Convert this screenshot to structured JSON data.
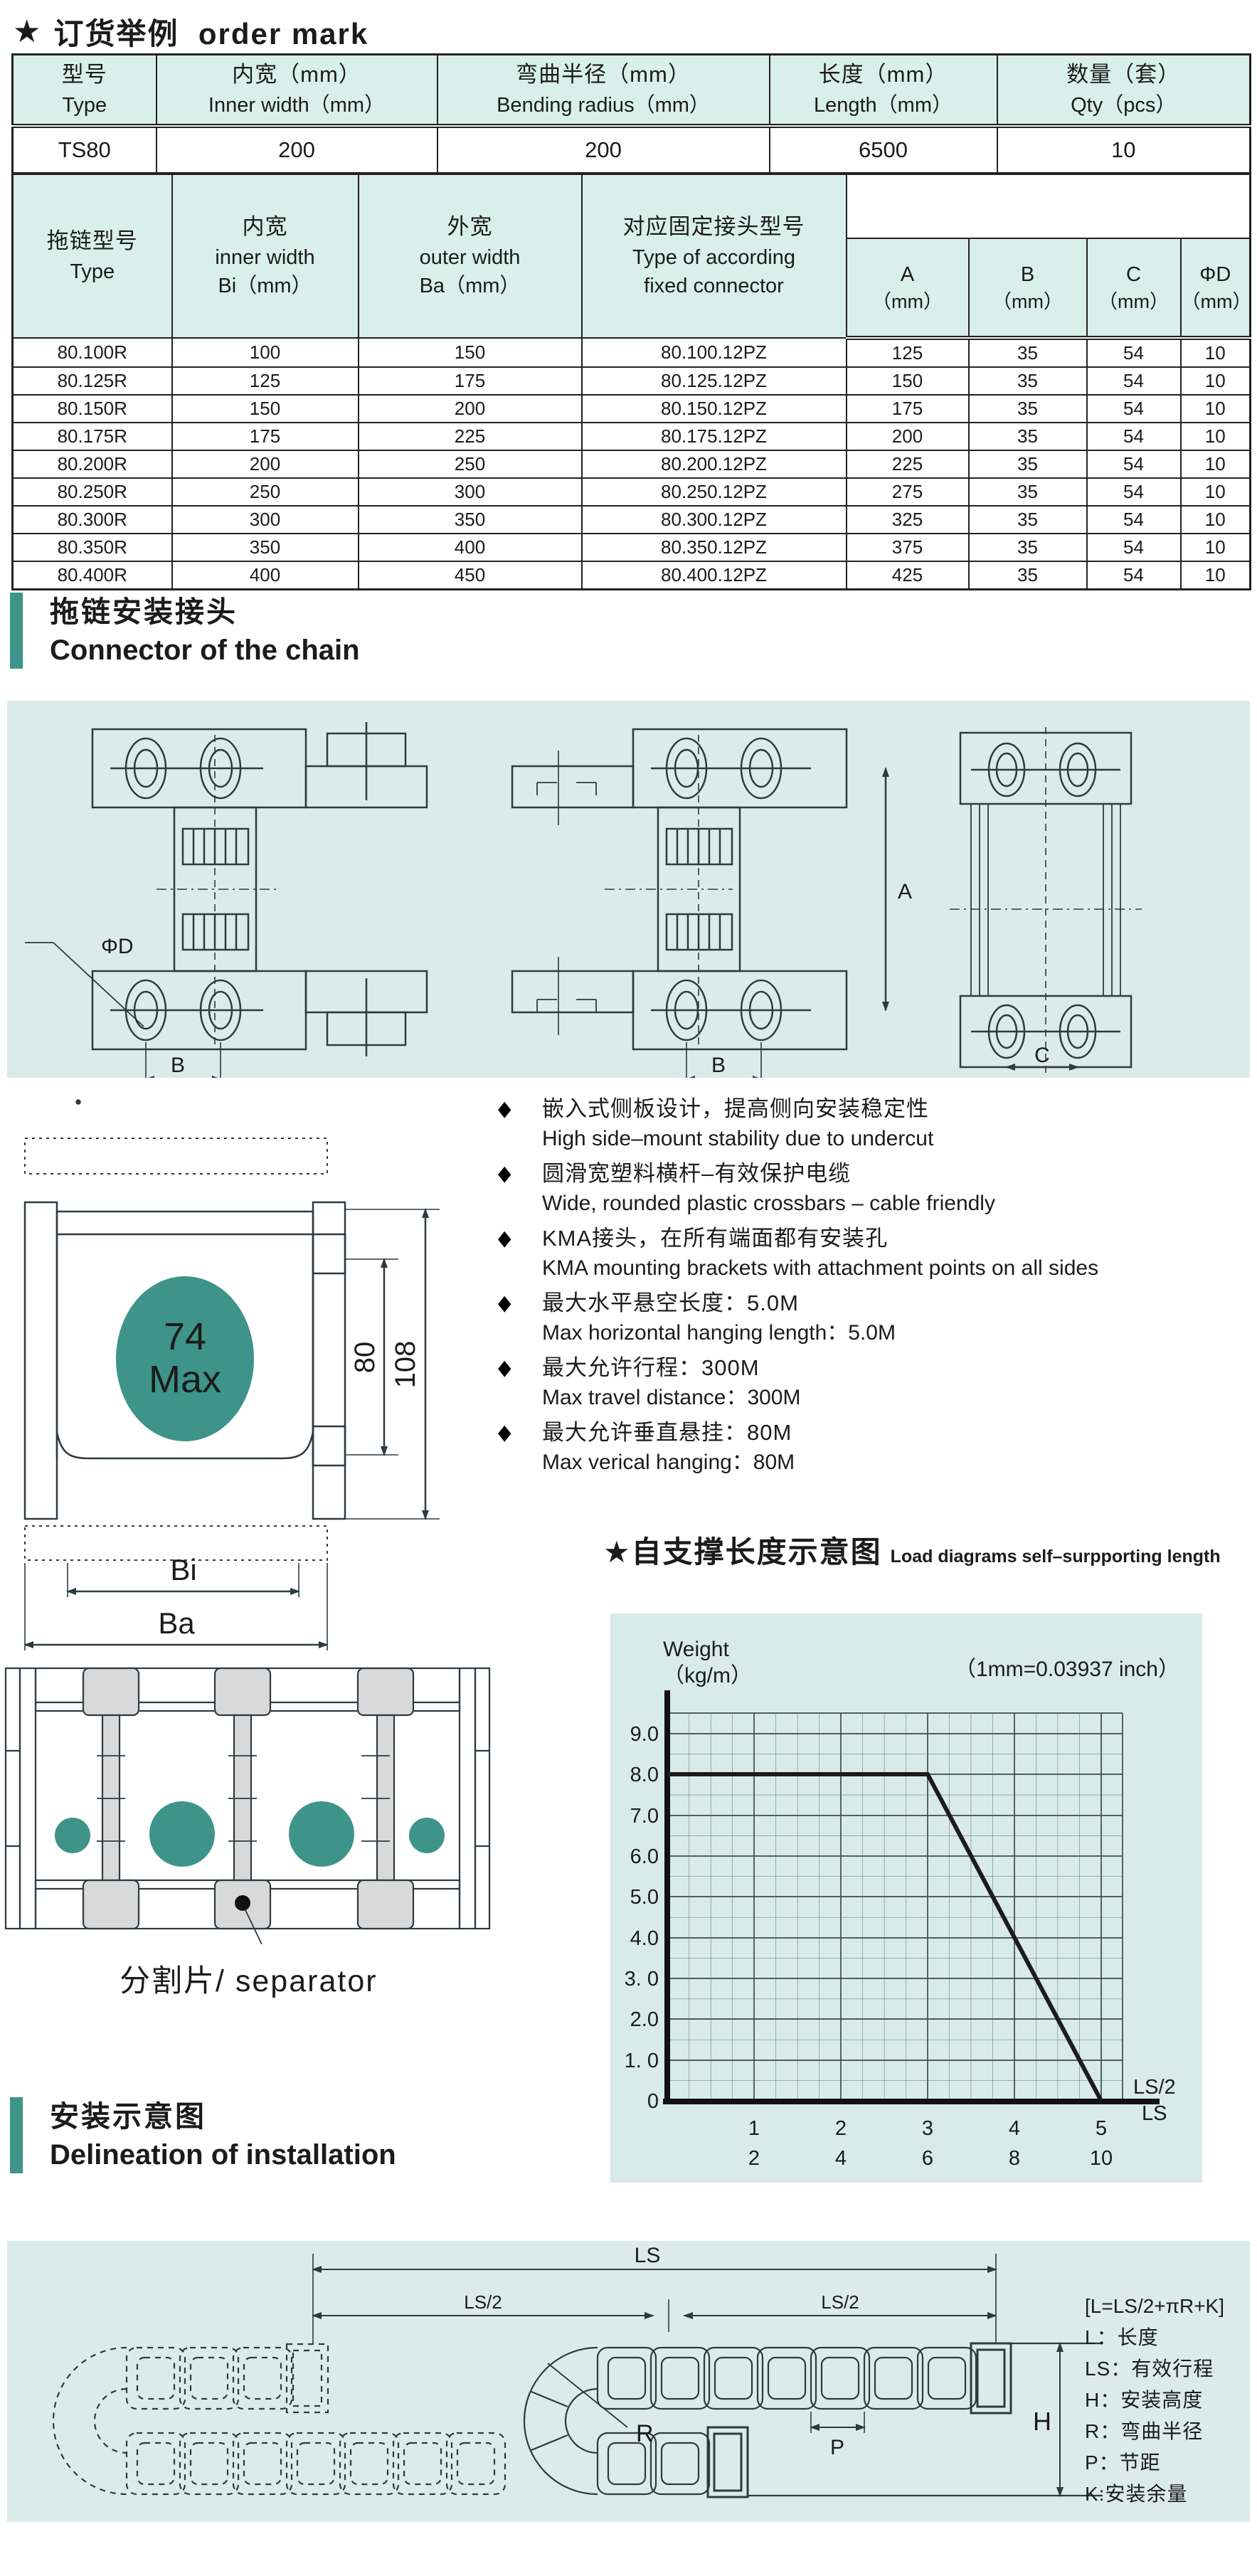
{
  "order_mark": {
    "star": "★",
    "zh": "订货举例",
    "en": "order mark"
  },
  "table1": {
    "headers": [
      {
        "zh": "型号",
        "en": "Type"
      },
      {
        "zh": "内宽（mm）",
        "en": "Inner width（mm）"
      },
      {
        "zh": "弯曲半径（mm）",
        "en": "Bending radius（mm）"
      },
      {
        "zh": "长度（mm）",
        "en": "Length（mm）"
      },
      {
        "zh": "数量（套）",
        "en": "Qty（pcs）"
      }
    ],
    "row": [
      "TS80",
      "200",
      "200",
      "6500",
      "10"
    ]
  },
  "table2": {
    "col_headers": [
      {
        "zh": "拖链型号",
        "en": "Type",
        "sub": ""
      },
      {
        "zh": "内宽",
        "en": "inner width",
        "sub": "Bi（mm）"
      },
      {
        "zh": "外宽",
        "en": "outer width",
        "sub": "Ba（mm）"
      },
      {
        "zh": "对应固定接头型号",
        "en": "Type of according",
        "sub": "fixed connector"
      }
    ],
    "dim_headers": [
      {
        "name": "A",
        "unit": "（mm）"
      },
      {
        "name": "B",
        "unit": "（mm）"
      },
      {
        "name": "C",
        "unit": "（mm）"
      },
      {
        "name": "ΦD",
        "unit": "（mm）"
      }
    ],
    "rows": [
      [
        "80.100R",
        "100",
        "150",
        "80.100.12PZ",
        "125",
        "35",
        "54",
        "10"
      ],
      [
        "80.125R",
        "125",
        "175",
        "80.125.12PZ",
        "150",
        "35",
        "54",
        "10"
      ],
      [
        "80.150R",
        "150",
        "200",
        "80.150.12PZ",
        "175",
        "35",
        "54",
        "10"
      ],
      [
        "80.175R",
        "175",
        "225",
        "80.175.12PZ",
        "200",
        "35",
        "54",
        "10"
      ],
      [
        "80.200R",
        "200",
        "250",
        "80.200.12PZ",
        "225",
        "35",
        "54",
        "10"
      ],
      [
        "80.250R",
        "250",
        "300",
        "80.250.12PZ",
        "275",
        "35",
        "54",
        "10"
      ],
      [
        "80.300R",
        "300",
        "350",
        "80.300.12PZ",
        "325",
        "35",
        "54",
        "10"
      ],
      [
        "80.350R",
        "350",
        "400",
        "80.350.12PZ",
        "375",
        "35",
        "54",
        "10"
      ],
      [
        "80.400R",
        "400",
        "450",
        "80.400.12PZ",
        "425",
        "35",
        "54",
        "10"
      ]
    ]
  },
  "section_connector": {
    "zh": "拖链安装接头",
    "en": "Connector of the chain"
  },
  "connector_labels": {
    "phi_d": "ΦD",
    "dim_b_left": "B",
    "dim_b_mid": "B",
    "dim_a": "A",
    "dim_c": "C"
  },
  "cross_section": {
    "circle_top": "74",
    "circle_bottom": "Max",
    "dim_inner_height": "80",
    "dim_outer_height": "108",
    "dim_bi": "Bi",
    "dim_ba": "Ba"
  },
  "features": [
    {
      "zh": "嵌入式侧板设计，提高侧向安装稳定性",
      "en": "High side–mount stability due to undercut"
    },
    {
      "zh": "圆滑宽塑料横杆–有效保护电缆",
      "en": "Wide, rounded plastic crossbars – cable friendly"
    },
    {
      "zh": "KMA接头，在所有端面都有安装孔",
      "en": "KMA mounting brackets with attachment points on all sides"
    },
    {
      "zh": "最大水平悬空长度：5.0M",
      "en": "Max horizontal hanging length：5.0M"
    },
    {
      "zh": "最大允许行程：300M",
      "en": "Max travel distance：300M"
    },
    {
      "zh": "最大允许垂直悬挂：80M",
      "en": "Max verical hanging：80M"
    }
  ],
  "separator_label": "分割片/ separator",
  "chart": {
    "star": "★",
    "title_zh": "自支撑长度示意图",
    "title_en": "Load diagrams self–surpporting length",
    "y_axis_line1": "Weight",
    "y_axis_line2": "（kg/m）",
    "note": "（1mm=0.03937 inch）",
    "y_ticks": [
      "9.0",
      "8.0",
      "7.0",
      "6.0",
      "5.0",
      "4.0",
      "3. 0",
      "2.0",
      "1. 0",
      "0"
    ],
    "x_ticks_top": [
      "1",
      "2",
      "3",
      "4",
      "5"
    ],
    "x_ticks_bottom": [
      "2",
      "4",
      "6",
      "8",
      "10"
    ],
    "x_label_top": "LS/2",
    "x_label_bottom": "LS"
  },
  "chart_data": {
    "type": "line",
    "title": "自支撑长度示意图 Load diagrams self-surpporting length",
    "xlabel": "LS/2 (top scale) / LS (bottom scale)",
    "ylabel": "Weight (kg/m)",
    "note": "1mm=0.03937 inch",
    "series": [
      {
        "name": "self-supporting load limit",
        "x_ls2": [
          0,
          3,
          5
        ],
        "y_kg_per_m": [
          8.0,
          8.0,
          0
        ]
      }
    ],
    "x_ticks_ls2": [
      1,
      2,
      3,
      4,
      5
    ],
    "x_ticks_ls": [
      2,
      4,
      6,
      8,
      10
    ],
    "xlim": [
      0,
      5.25
    ],
    "ylim": [
      0,
      9.5
    ],
    "grid": true,
    "legend_position": "none"
  },
  "section_installation": {
    "zh": "安装示意图",
    "en": "Delineation of installation"
  },
  "install": {
    "dim_ls": "LS",
    "dim_ls2_left": "LS/2",
    "dim_ls2_right": "LS/2",
    "dim_p": "P",
    "dim_r": "R",
    "dim_h": "H",
    "formula": "[L=LS/2+πR+K]",
    "legend": [
      "L：长度",
      "LS：有效行程",
      "H：安装高度",
      "R：弯曲半径",
      "P：节距",
      "K:安装余量"
    ]
  },
  "colors": {
    "accent_teal": "#3e9489",
    "table_header_bg": "#d9efe9",
    "panel_bg": "#dbebe9",
    "line": "#3a454d"
  }
}
